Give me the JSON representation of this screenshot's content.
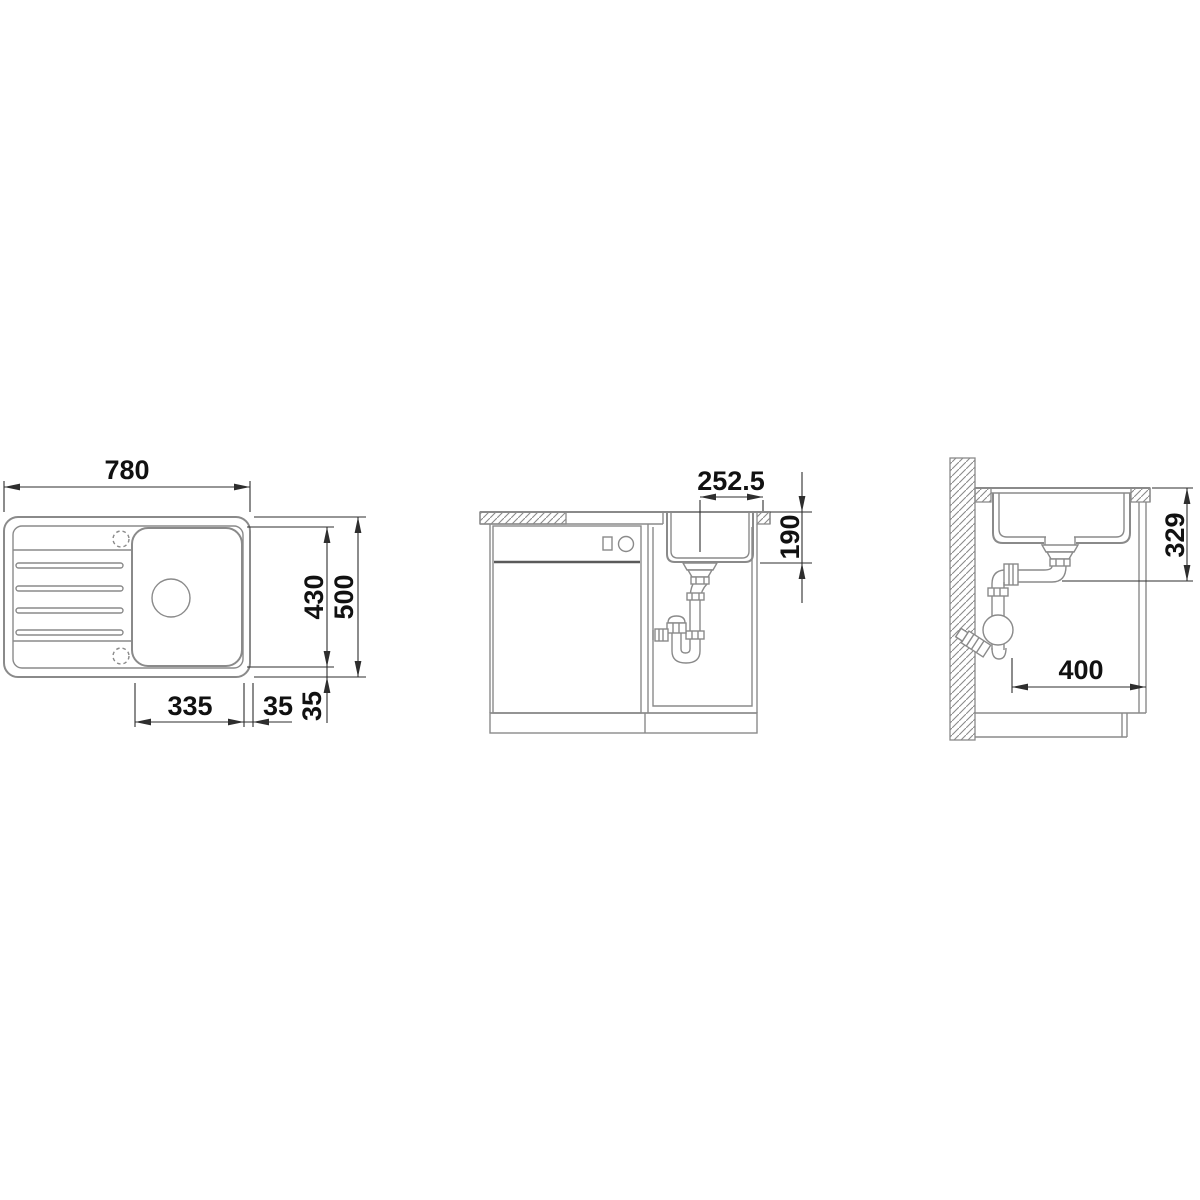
{
  "drawing": {
    "title": "sink-installation-drawing",
    "colors": {
      "background": "#ffffff",
      "part_line": "#8a8a8a",
      "dimension_line": "#2e2e2e",
      "text": "#111111"
    },
    "views": {
      "top": {
        "dims": {
          "overall_width": "780",
          "overall_depth": "500",
          "bowl_depth": "430",
          "bowl_width": "335",
          "rim_side": "35",
          "rim_bottom": "35"
        }
      },
      "front": {
        "dims": {
          "drain_center_to_worktop_edge": "252.5",
          "bowl_depth_below_worktop": "190"
        }
      },
      "side": {
        "dims": {
          "worktop_to_drain_outlet": "329",
          "rear_clearance": "400"
        }
      }
    }
  }
}
